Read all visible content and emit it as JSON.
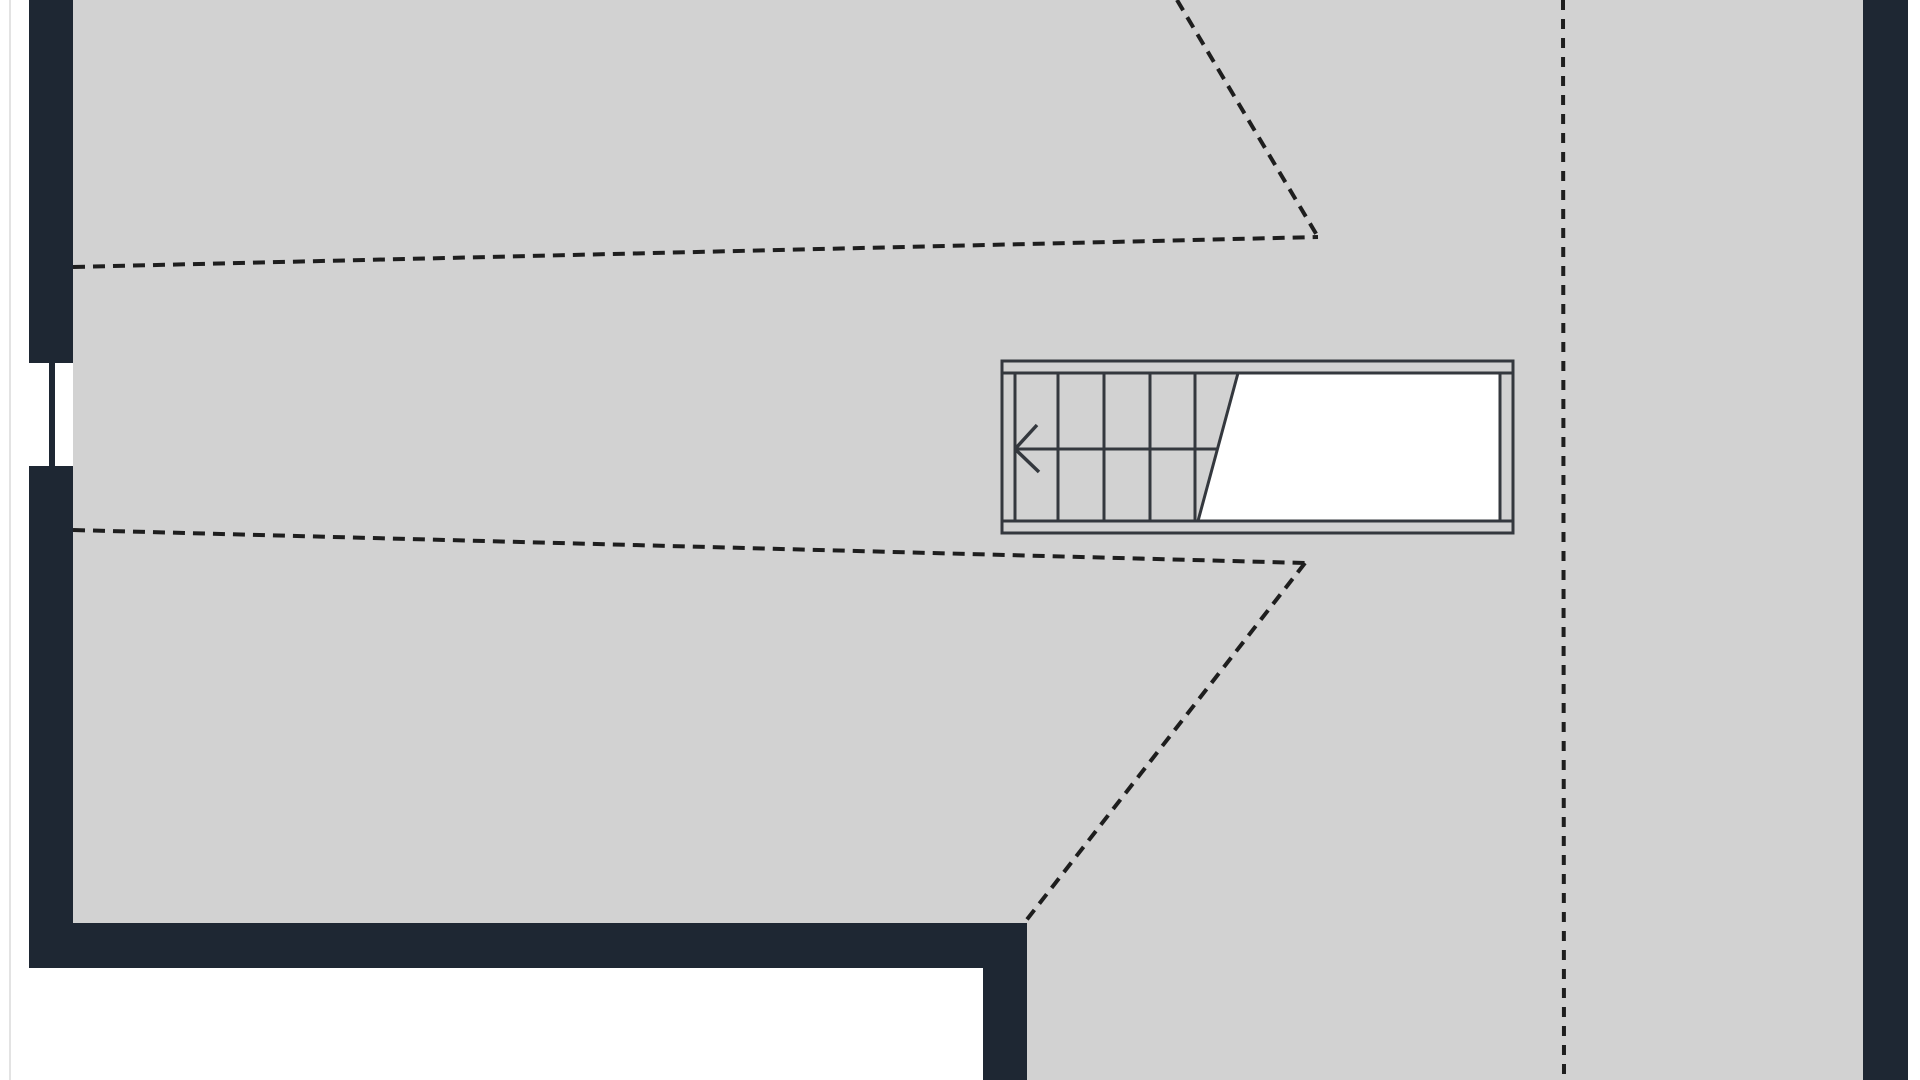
{
  "canvas": {
    "width": 1920,
    "height": 1080
  },
  "colors": {
    "background": "#ffffff",
    "floor": "#d2d2d2",
    "wall": "#1e2733",
    "stair_line": "#34383e",
    "void": "#ffffff",
    "dash": "#1e1e1e",
    "page_edge": "#e3e3e3"
  },
  "page_edge_line": {
    "x": 10,
    "y1": 0,
    "y2": 1080,
    "width": 2
  },
  "floor": {
    "rects": [
      {
        "x": 73,
        "y": 0,
        "w": 1790,
        "h": 925
      },
      {
        "x": 1027,
        "y": 925,
        "w": 836,
        "h": 155
      }
    ]
  },
  "walls": [
    {
      "name": "left-exterior-wall",
      "x": 29,
      "y": 0,
      "w": 44,
      "h": 968
    },
    {
      "name": "bottom-interior-wall",
      "x": 29,
      "y": 923,
      "w": 998,
      "h": 45
    },
    {
      "name": "bottom-wall-return-stub",
      "x": 983,
      "y": 923,
      "w": 44,
      "h": 157
    },
    {
      "name": "right-exterior-wall",
      "x": 1863,
      "y": 0,
      "w": 45,
      "h": 1080
    }
  ],
  "window": {
    "opening": {
      "x": 29,
      "y": 363,
      "w": 44,
      "h": 103
    },
    "mullion": {
      "x": 49,
      "y": 363,
      "w": 6,
      "h": 103
    }
  },
  "staircase": {
    "outer_box": {
      "x": 1002,
      "y": 361,
      "w": 511,
      "h": 172
    },
    "void_polygon": [
      [
        1238,
        373
      ],
      [
        1500,
        373
      ],
      [
        1500,
        521
      ],
      [
        1198,
        521
      ]
    ],
    "rail_inner_lines": [
      [
        1002,
        373,
        1513,
        373
      ],
      [
        1002,
        521,
        1513,
        521
      ]
    ],
    "right_cap_line": [
      1500,
      373,
      1500,
      521
    ],
    "tread_lines": [
      [
        1015,
        373,
        1015,
        521
      ],
      [
        1058,
        373,
        1058,
        521
      ],
      [
        1104,
        373,
        1104,
        521
      ],
      [
        1150,
        373,
        1150,
        521
      ],
      [
        1195,
        373,
        1195,
        521
      ]
    ],
    "break_line": [
      1238,
      373,
      1198,
      521
    ],
    "walk_line": [
      1015,
      449,
      1217,
      449
    ],
    "arrow": {
      "tip": [
        1015,
        449
      ],
      "barbs": [
        [
          1037,
          425
        ],
        [
          1039,
          472
        ]
      ]
    }
  },
  "dashed_lines": [
    {
      "name": "upper-headroom-line-horizontal",
      "x1": 73,
      "y1": 267,
      "x2": 1318,
      "y2": 237,
      "dasharray": "12 8"
    },
    {
      "name": "upper-headroom-line-diagonal",
      "x1": 1177,
      "y1": 0,
      "x2": 1318,
      "y2": 237,
      "dasharray": "12 8"
    },
    {
      "name": "lower-headroom-line-horizontal",
      "x1": 73,
      "y1": 530,
      "x2": 1305,
      "y2": 563,
      "dasharray": "12 8"
    },
    {
      "name": "lower-headroom-line-diagonal",
      "x1": 1305,
      "y1": 563,
      "x2": 1025,
      "y2": 922,
      "dasharray": "12 8"
    },
    {
      "name": "ridge-line-vertical",
      "x1": 1563,
      "y1": 0,
      "x2": 1564,
      "y2": 1080,
      "dasharray": "10 9"
    }
  ],
  "dash_style": {
    "width": 4
  },
  "stroke_style": {
    "outline_width": 3,
    "detail_width": 3,
    "arrow_width": 3.5
  }
}
